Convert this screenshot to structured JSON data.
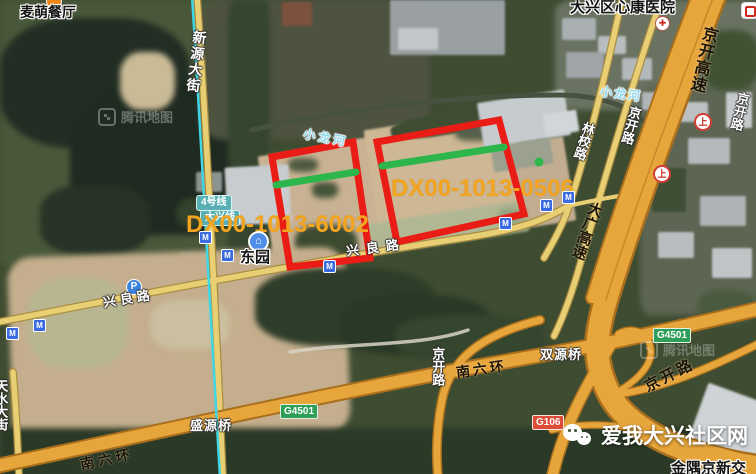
{
  "map_type": "satellite",
  "watermark": {
    "brand": "腾讯地图"
  },
  "attribution": {
    "site": "爱我大兴社区网",
    "compound": "金隅京新交"
  },
  "pois": {
    "restaurant": "麦萌餐厅",
    "hospital": "大兴区心康医院",
    "station": "东园"
  },
  "roads": {
    "xinyuan_dajie": "新源大街",
    "jingkai_expwy": "京开高速",
    "jingkai_lu": "京开路",
    "linxiao_lu": "林校路",
    "daguang_expwy": "大广高速",
    "xingliang_lu": "兴良路",
    "nanliuhuan": "南六环",
    "tianshui_dajie": "天水大街"
  },
  "bridges": {
    "shuangyuan": "双源桥",
    "shengyuan": "盛源桥"
  },
  "river": "小龙河",
  "badges": {
    "g4501": "G4501",
    "g106": "G106"
  },
  "transit": {
    "line4": "4号线",
    "daxing_line": "大兴线",
    "metro": "M",
    "parking": "P",
    "gate": "上"
  },
  "parcels": [
    {
      "id": "DX00-1013-6002"
    },
    {
      "id": "DX00-1013-0506"
    }
  ],
  "colors": {
    "parcel_outline": "#ea1c16",
    "parcel_inner_line": "#2db64c",
    "parcel_label": "#f4a51f",
    "metro_line": "#3fd6e6",
    "expressway": "#e7a63c",
    "minor_road": "#e8cf74"
  }
}
